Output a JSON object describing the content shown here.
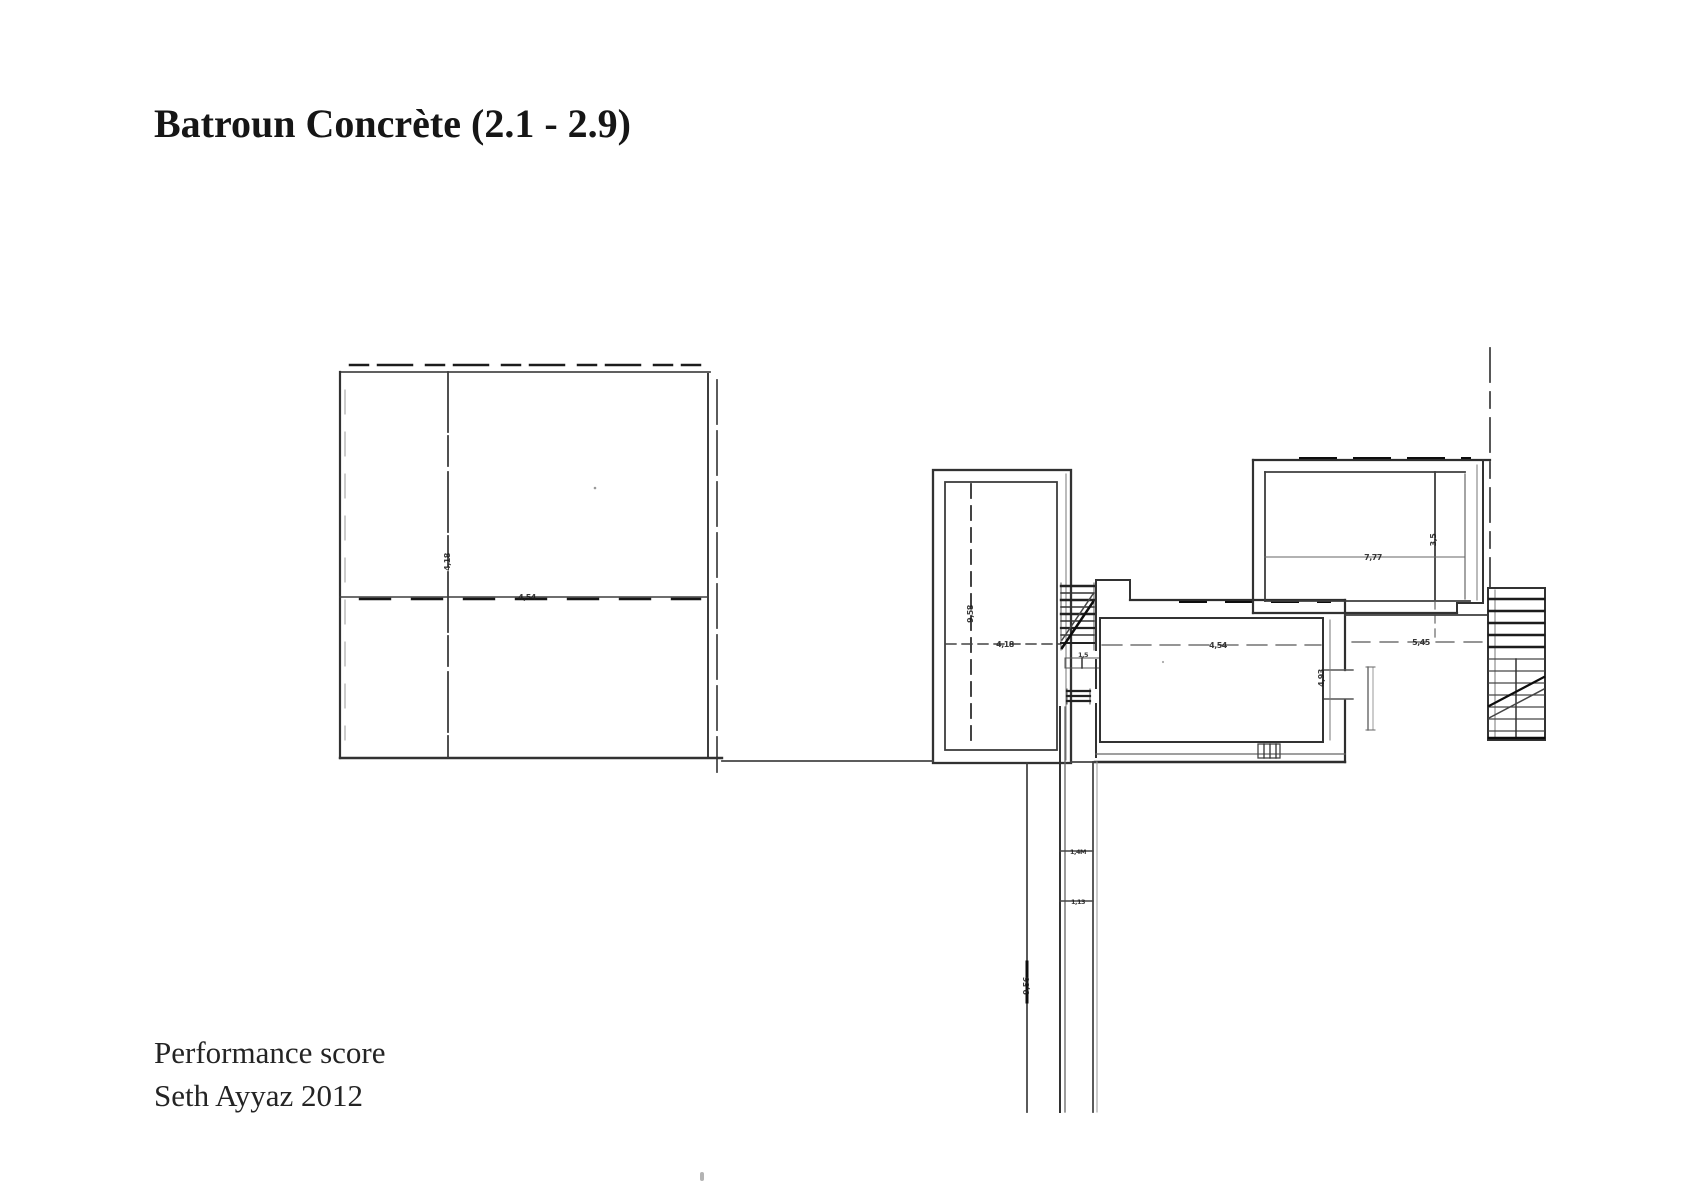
{
  "page": {
    "background": "#ffffff",
    "title": "Batroun Concrète (2.1 - 2.9)",
    "credit_line1": "Performance score",
    "credit_line2": "Seth Ayyaz 2012",
    "text_color": "#1a1a1a"
  },
  "plan": {
    "ink_color": "#2f2f2f",
    "labels": {
      "a_vert": "4,18",
      "a_horiz": "4,54",
      "b_vert": "9,58",
      "b_horiz": "4,18",
      "conn": "1,5",
      "c_horiz": "4,54",
      "c_vert": "4,93",
      "d_horiz": "7,77",
      "d_vert": "3,5",
      "e_dim": "5,45",
      "cor_tick1": "1,4M",
      "cor_tick2": "1,13",
      "cor_vert": "9,56"
    }
  }
}
